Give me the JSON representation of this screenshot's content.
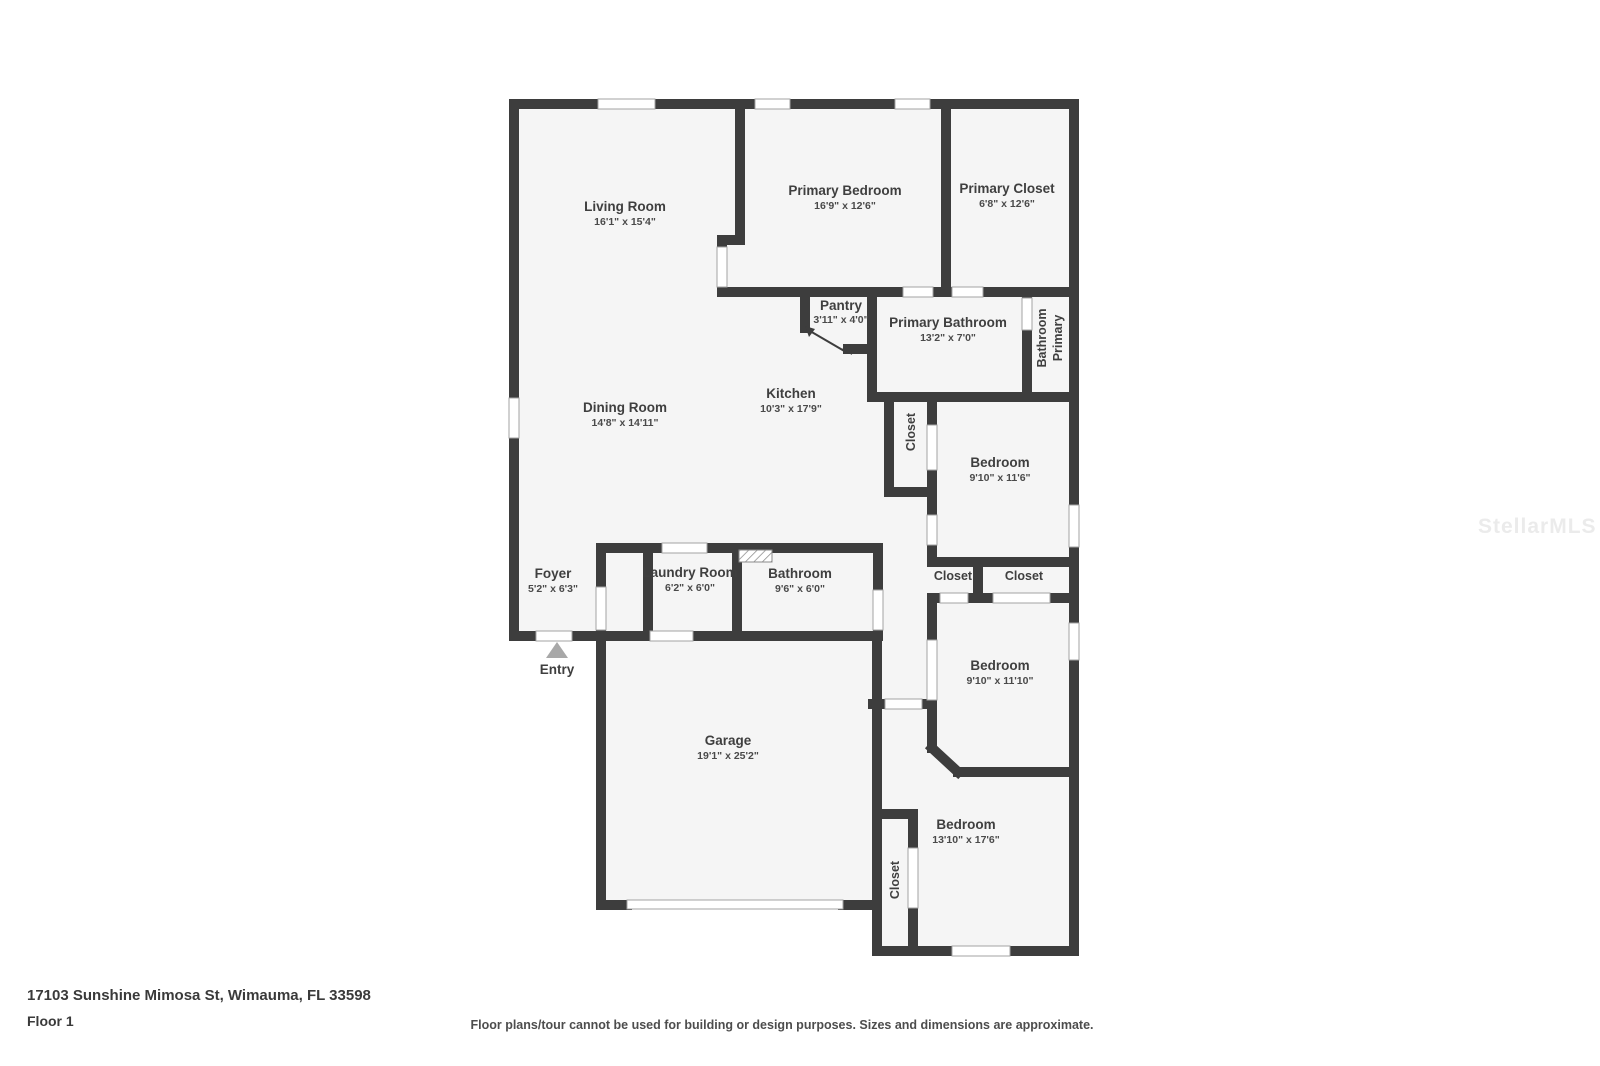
{
  "plan": {
    "rooms": {
      "living": {
        "name": "Living Room",
        "dims": "16'1\" x 15'4\""
      },
      "primary_bedroom": {
        "name": "Primary Bedroom",
        "dims": "16'9\" x 12'6\""
      },
      "primary_closet": {
        "name": "Primary Closet",
        "dims": "6'8\" x 12'6\""
      },
      "pantry": {
        "name": "Pantry",
        "dims": "3'11\" x 4'0\""
      },
      "primary_bathroom": {
        "name": "Primary Bathroom",
        "dims": "13'2\" x 7'0\""
      },
      "primary_bath_strip": {
        "lines": [
          "Primary",
          "Bathroom"
        ]
      },
      "kitchen": {
        "name": "Kitchen",
        "dims": "10'3\" x 17'9\""
      },
      "closet_kitchen": {
        "name": "Closet"
      },
      "dining": {
        "name": "Dining Room",
        "dims": "14'8\" x 14'11\""
      },
      "bedroom1": {
        "name": "Bedroom",
        "dims": "9'10\" x 11'6\""
      },
      "foyer": {
        "name": "Foyer",
        "dims": "5'2\" x 6'3\""
      },
      "laundry": {
        "name": "Laundry Room",
        "dims": "6'2\" x 6'0\""
      },
      "bathroom": {
        "name": "Bathroom",
        "dims": "9'6\" x 6'0\""
      },
      "closet_hall_1": {
        "name": "Closet"
      },
      "closet_hall_2": {
        "name": "Closet"
      },
      "bedroom2": {
        "name": "Bedroom",
        "dims": "9'10\" x 11'10\""
      },
      "garage": {
        "name": "Garage",
        "dims": "19'1\" x 25'2\""
      },
      "closet_bottom": {
        "name": "Closet"
      },
      "bedroom3": {
        "name": "Bedroom",
        "dims": "13'10\" x 17'6\""
      }
    },
    "entry_label": "Entry"
  },
  "footer": {
    "address": "17103 Sunshine Mimosa St, Wimauma, FL 33598",
    "floor": "Floor 1",
    "disclaimer": "Floor plans/tour cannot be used for building or design purposes. Sizes and dimensions are approximate."
  },
  "watermark": "StellarMLS",
  "colors": {
    "wall": "#3d3d3d",
    "floor_fill": "#f5f5f5",
    "label_text": "#3f3f3f",
    "opening_outline": "#a3a3a3",
    "entry_arrow": "#a8a8a8",
    "watermark": "#ebebeb"
  }
}
